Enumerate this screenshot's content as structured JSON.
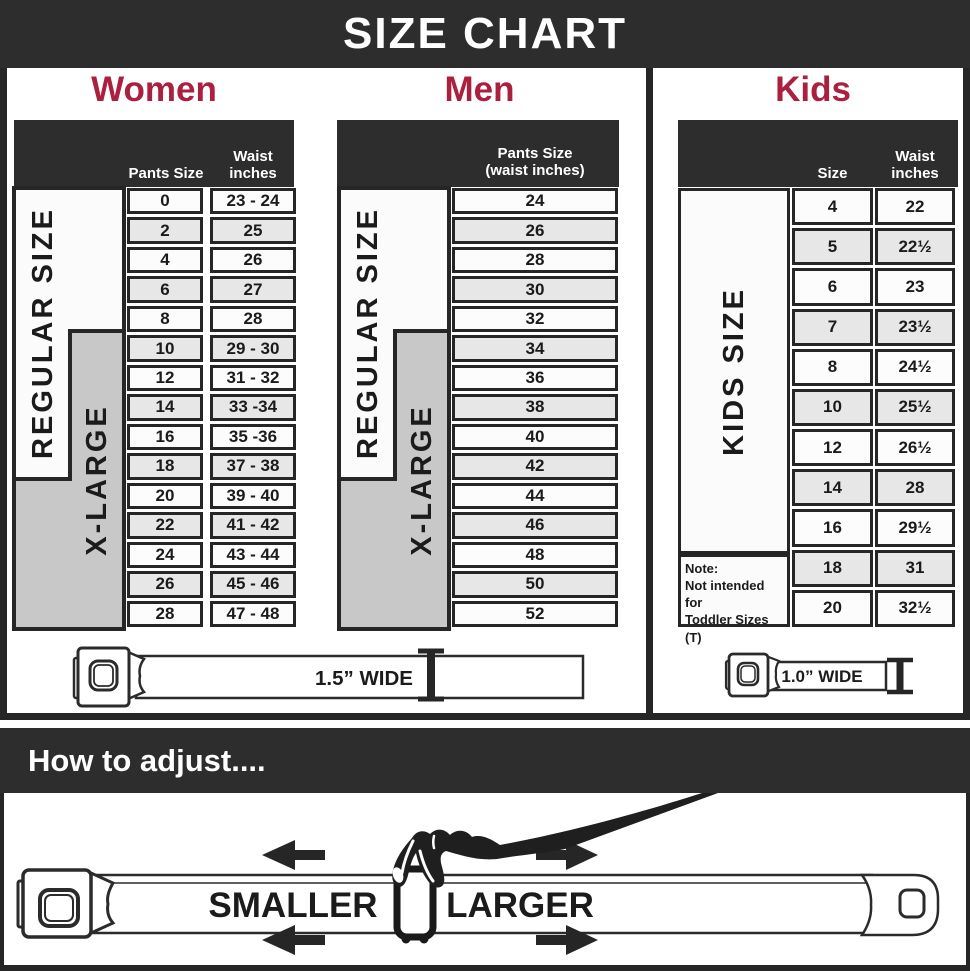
{
  "title": "SIZE CHART",
  "colors": {
    "accent_red": "#ab1f3f",
    "dark": "#2d2d2d",
    "row_alt": "#e7e7e7",
    "xlarge_gray": "#c8c8c8"
  },
  "women": {
    "title": "Women",
    "header": {
      "pants": "Pants Size",
      "waist1": "Waist",
      "waist2": "inches"
    },
    "regular_label": "REGULAR SIZE",
    "xlarge_label": "X-LARGE",
    "rows": [
      {
        "size": "0",
        "waist": "23 - 24"
      },
      {
        "size": "2",
        "waist": "25"
      },
      {
        "size": "4",
        "waist": "26"
      },
      {
        "size": "6",
        "waist": "27"
      },
      {
        "size": "8",
        "waist": "28"
      },
      {
        "size": "10",
        "waist": "29 - 30"
      },
      {
        "size": "12",
        "waist": "31 - 32"
      },
      {
        "size": "14",
        "waist": "33 -34"
      },
      {
        "size": "16",
        "waist": "35 -36"
      },
      {
        "size": "18",
        "waist": "37 - 38"
      },
      {
        "size": "20",
        "waist": "39 - 40"
      },
      {
        "size": "22",
        "waist": "41 - 42"
      },
      {
        "size": "24",
        "waist": "43 - 44"
      },
      {
        "size": "26",
        "waist": "45 - 46"
      },
      {
        "size": "28",
        "waist": "47 - 48"
      }
    ]
  },
  "men": {
    "title": "Men",
    "header1": "Pants Size",
    "header2": "(waist inches)",
    "regular_label": "REGULAR SIZE",
    "xlarge_label": "X-LARGE",
    "rows": [
      "24",
      "26",
      "28",
      "30",
      "32",
      "34",
      "36",
      "38",
      "40",
      "42",
      "44",
      "46",
      "48",
      "50",
      "52"
    ]
  },
  "kids": {
    "title": "Kids",
    "header": {
      "size": "Size",
      "waist1": "Waist",
      "waist2": "inches"
    },
    "side_label": "KIDS SIZE",
    "note1": "Note:",
    "note2": "Not intended for",
    "note3": "Toddler Sizes (T)",
    "rows": [
      {
        "size": "4",
        "waist": "22"
      },
      {
        "size": "5",
        "waist": "22½"
      },
      {
        "size": "6",
        "waist": "23"
      },
      {
        "size": "7",
        "waist": "23½"
      },
      {
        "size": "8",
        "waist": "24½"
      },
      {
        "size": "10",
        "waist": "25½"
      },
      {
        "size": "12",
        "waist": "26½"
      },
      {
        "size": "14",
        "waist": "28"
      },
      {
        "size": "16",
        "waist": "29½"
      },
      {
        "size": "18",
        "waist": "31"
      },
      {
        "size": "20",
        "waist": "32½"
      }
    ]
  },
  "belts": {
    "adult_label": "1.5” WIDE",
    "kids_label": "1.0” WIDE"
  },
  "adjust": {
    "heading": "How to adjust....",
    "smaller": "SMALLER",
    "larger": "LARGER"
  }
}
